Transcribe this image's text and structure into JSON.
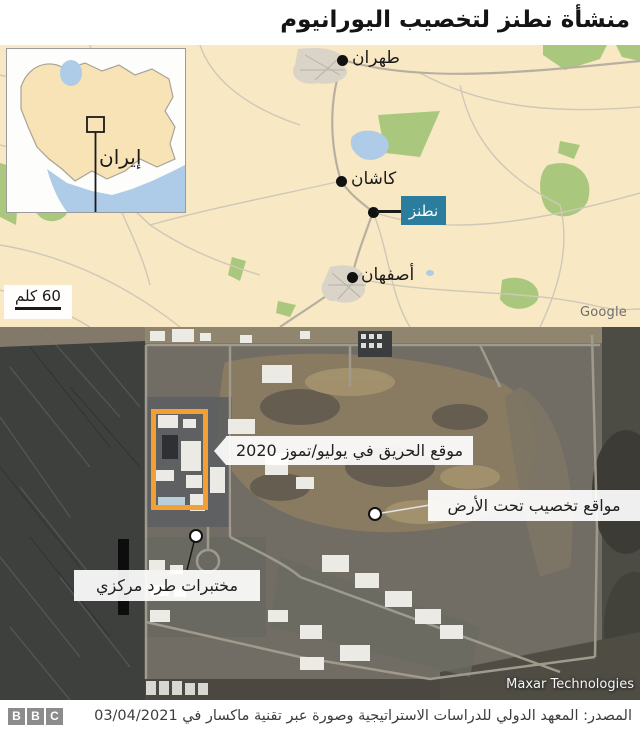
{
  "title": "منشأة نطنز لتخصيب اليورانيوم",
  "map": {
    "inset": {
      "country_label": "إيران"
    },
    "cities": {
      "tehran": "طهران",
      "kashan": "كاشان",
      "natanz": "نطنز",
      "isfahan": "أصفهان"
    },
    "scale_label": "60 كلم",
    "attribution": "Google",
    "colors": {
      "land": "#f8e8c4",
      "vegetation": "#a9c87d",
      "water": "#aecbe8",
      "natanz_box": "#2a7d9c"
    }
  },
  "satellite": {
    "annotations": {
      "fire_site": "موقع الحريق في يوليو/تموز 2020",
      "underground": "مواقع تخصيب تحت الأرض",
      "centrifuge": "مختبرات طرد مركزي"
    },
    "attribution": "Maxar Technologies",
    "highlight_color": "#f2a033"
  },
  "footer": {
    "logo_letters": [
      "B",
      "B",
      "C"
    ],
    "source": "المصدر: المعهد الدولي للدراسات الاستراتيجية وصورة عبر تقنية ماكسار في 03/04/2021"
  }
}
